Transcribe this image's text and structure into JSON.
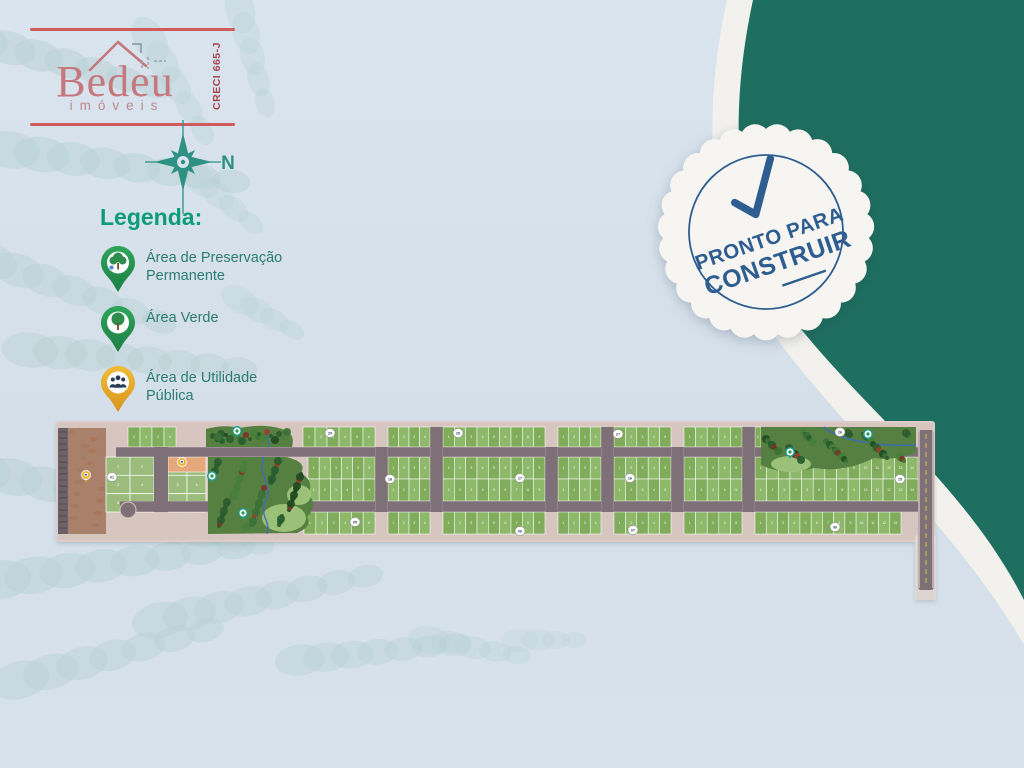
{
  "logo": {
    "brand": "Bedeu",
    "subtitle": "imóveis",
    "creci": "CRECI 665-J",
    "accent_line_color": "#d15a5e",
    "brand_color": "#c5797e"
  },
  "compass": {
    "north_label": "N",
    "color": "#2f9183"
  },
  "legend": {
    "title": "Legenda:",
    "title_color": "#0e9b77",
    "text_color": "#2c7c72",
    "pin_green": "#2fa55b",
    "pin_yellow": "#eeb42f",
    "items": [
      {
        "icon": "green-tree-water-pin",
        "label_lines": [
          "Área de Preservação",
          "Permanente"
        ]
      },
      {
        "icon": "green-tree-pin",
        "label_lines": [
          "Área Verde"
        ]
      },
      {
        "icon": "yellow-people-pin",
        "label_lines": [
          "Área de Utilidade",
          "Pública"
        ]
      }
    ]
  },
  "badge": {
    "line1": "PRONTO PARA",
    "line2": "CONSTRUIR",
    "color": "#2e5d90",
    "bg": "#f7f5f2",
    "scallops": 27,
    "radius": 103,
    "rotation": -19
  },
  "corner": {
    "teal": "#1e6f60",
    "band": "#f2f1ee",
    "teal_path": "M753 0 C727 120 736 235 783 305 C850 400 962 478 1024 600 L1024 0 Z",
    "band_path": "M727 0 C700 120 710 240 760 315 C830 420 952 520 1024 645 L1024 0 Z"
  },
  "decor": {
    "color": "#b7d1d3",
    "fronds": [
      {
        "x": -20,
        "y": 40,
        "a": 15,
        "n": 7,
        "s": 30,
        "op": 0.5
      },
      {
        "x": 10,
        "y": 150,
        "a": 8,
        "n": 8,
        "s": 32,
        "op": 0.5
      },
      {
        "x": -10,
        "y": 260,
        "a": 20,
        "n": 7,
        "s": 30,
        "op": 0.45
      },
      {
        "x": 30,
        "y": 350,
        "a": 5,
        "n": 8,
        "s": 30,
        "op": 0.45
      },
      {
        "x": -20,
        "y": 470,
        "a": 12,
        "n": 7,
        "s": 34,
        "op": 0.5
      },
      {
        "x": 0,
        "y": 580,
        "a": -8,
        "n": 8,
        "s": 34,
        "op": 0.5
      },
      {
        "x": 20,
        "y": 680,
        "a": -15,
        "n": 7,
        "s": 32,
        "op": 0.45
      },
      {
        "x": 150,
        "y": 40,
        "a": 60,
        "n": 5,
        "s": 26,
        "op": 0.35
      },
      {
        "x": 240,
        "y": 10,
        "a": 75,
        "n": 5,
        "s": 24,
        "op": 0.3
      },
      {
        "x": 160,
        "y": 620,
        "a": -12,
        "n": 8,
        "s": 30,
        "op": 0.45
      },
      {
        "x": 300,
        "y": 660,
        "a": -6,
        "n": 7,
        "s": 26,
        "op": 0.4
      },
      {
        "x": 430,
        "y": 640,
        "a": 10,
        "n": 5,
        "s": 22,
        "op": 0.3
      },
      {
        "x": 240,
        "y": 300,
        "a": 30,
        "n": 4,
        "s": 20,
        "op": 0.3
      },
      {
        "x": 200,
        "y": 180,
        "a": 40,
        "n": 4,
        "s": 22,
        "op": 0.3
      },
      {
        "x": 520,
        "y": 640,
        "a": 0,
        "n": 4,
        "s": 18,
        "op": 0.22
      },
      {
        "x": 120,
        "y": 520,
        "a": 10,
        "n": 6,
        "s": 28,
        "op": 0.4
      }
    ]
  },
  "map": {
    "origin": {
      "left": 56,
      "top": 420,
      "width": 880,
      "height": 180
    },
    "palette": {
      "sidewalk": "#d7c5c0",
      "strip_edge": "#ddccc8",
      "road": "#7d7076",
      "road_edge": "#a2939a",
      "road_dark": "#6b6168",
      "hatch": "#574f55",
      "lot_a": "#80ac5b",
      "lot_b": "#8eb96a",
      "lot_num": "#ffffff",
      "column_lot": "#9cbc7d",
      "field": "#a98069",
      "field_spot_a": "#b0572f",
      "field_spot_b": "#8a6a54",
      "forest_base": "#567f42",
      "meadow": "#a3c87e",
      "stream": "#3c6cc0",
      "tree_greens": [
        "#2d5b2e",
        "#3c7137",
        "#1f4a22",
        "#477f3b",
        "#265c2f"
      ],
      "tree_reds": [
        "#9c3d2a",
        "#7e3322"
      ],
      "dash_yellow": "#d9c05a",
      "orange_patch": "#e5a87c",
      "curb": "#d9c6c2",
      "pin_teal": "#1f9a8a",
      "pin_tree": "#2f9e58",
      "pin_yellow": "#eab02f",
      "pin_people": "#2c3b57",
      "marker_num": "#3a4a63"
    },
    "lot_w": 11.5,
    "strip": {
      "x": 1,
      "y": 2,
      "w": 877,
      "h": 119
    },
    "left_road": {
      "x": 2,
      "y": 8,
      "w": 10,
      "h": 106
    },
    "field": {
      "x": 12,
      "y": 8,
      "w": 38,
      "h": 106
    },
    "column": {
      "x": 50,
      "y": 37,
      "w": 48,
      "h": 55,
      "cols": 2,
      "rows": 3
    },
    "v0_road": {
      "x": 98,
      "y": 27,
      "w": 14,
      "h": 65
    },
    "east_block": {
      "x": 112,
      "y": 37,
      "w": 38,
      "h": 55,
      "cols": 2,
      "rows": 3
    },
    "orange_patch": {
      "x": 112,
      "y": 37,
      "w": 38,
      "h": 15
    },
    "turnaround": {
      "cx": 72,
      "cy": 90,
      "r": 8
    },
    "road_a": {
      "x": 60,
      "y": 27,
      "w": 802,
      "h": 10
    },
    "road_b": {
      "x": 64,
      "y": 81,
      "w": 814,
      "h": 11
    },
    "rows": {
      "top": [
        7,
        27
      ],
      "mid_a": [
        37,
        59
      ],
      "mid_b": [
        59,
        81
      ],
      "bottom": [
        92,
        114
      ]
    },
    "extents": {
      "top": [
        247,
        705
      ],
      "top_left": [
        72,
        120
      ],
      "mid": [
        252,
        862
      ],
      "bottom": [
        248,
        845
      ]
    },
    "cross_roads": {
      "xs": [
        319,
        374,
        489,
        545,
        615,
        686
      ],
      "w": 13,
      "full_span": [
        374,
        545,
        686
      ]
    },
    "right_road": {
      "x": 862,
      "y": 10,
      "w": 16,
      "h": 160
    },
    "forest_left_top": "M150 27 L150 9 Q168 4 184 8 Q208 3 226 9 Q240 13 236 27 Z",
    "forest_left": "M152 37 L230 37 Q252 42 245 53 Q259 62 252 74 Q263 85 251 97 Q257 106 241 113 L152 114 Z",
    "forest_right": "M705 7 L860 7 L860 33 Q838 41 818 38 Q788 53 758 48 Q728 56 705 45 Z",
    "meadow_blobs": [
      {
        "cx": 228,
        "cy": 98,
        "rx": 22,
        "ry": 14
      },
      {
        "cx": 243,
        "cy": 75,
        "rx": 12,
        "ry": 10
      },
      {
        "cx": 735,
        "cy": 44,
        "rx": 20,
        "ry": 8
      }
    ],
    "streams": [
      {
        "d": "M208 37 C200 55 218 66 210 80 C202 95 216 103 211 114",
        "w": 1.5
      },
      {
        "d": "M212 9 C208 16 216 21 212 27",
        "w": 1.2
      },
      {
        "d": "M768 7 C782 20 822 27 860 25",
        "w": 1.5
      }
    ],
    "tree_fields": [
      {
        "x": 150,
        "y": 37,
        "w": 100,
        "h": 75,
        "count": 64,
        "seed": 5
      },
      {
        "x": 150,
        "y": 8,
        "w": 86,
        "h": 18,
        "count": 22,
        "seed": 11
      },
      {
        "x": 706,
        "y": 8,
        "w": 154,
        "h": 38,
        "count": 52,
        "seed": 23
      }
    ],
    "quadra_markers": [
      {
        "x": 274,
        "y": 13,
        "n": "29"
      },
      {
        "x": 402,
        "y": 13,
        "n": "28"
      },
      {
        "x": 562,
        "y": 14,
        "n": "27"
      },
      {
        "x": 784,
        "y": 12,
        "n": "26"
      },
      {
        "x": 56,
        "y": 57,
        "n": "01"
      },
      {
        "x": 334,
        "y": 59,
        "n": "18"
      },
      {
        "x": 464,
        "y": 58,
        "n": "17"
      },
      {
        "x": 574,
        "y": 58,
        "n": "16"
      },
      {
        "x": 844,
        "y": 59,
        "n": "15"
      },
      {
        "x": 299,
        "y": 102,
        "n": "05"
      },
      {
        "x": 464,
        "y": 111,
        "n": "06"
      },
      {
        "x": 577,
        "y": 110,
        "n": "07"
      },
      {
        "x": 779,
        "y": 107,
        "n": "08"
      }
    ],
    "teal_pins": [
      {
        "x": 181,
        "y": 11
      },
      {
        "x": 187,
        "y": 93
      },
      {
        "x": 156,
        "y": 56
      },
      {
        "x": 734,
        "y": 32
      },
      {
        "x": 812,
        "y": 14
      }
    ],
    "yellow_pins": [
      {
        "x": 30,
        "y": 55
      },
      {
        "x": 126,
        "y": 42
      }
    ]
  }
}
